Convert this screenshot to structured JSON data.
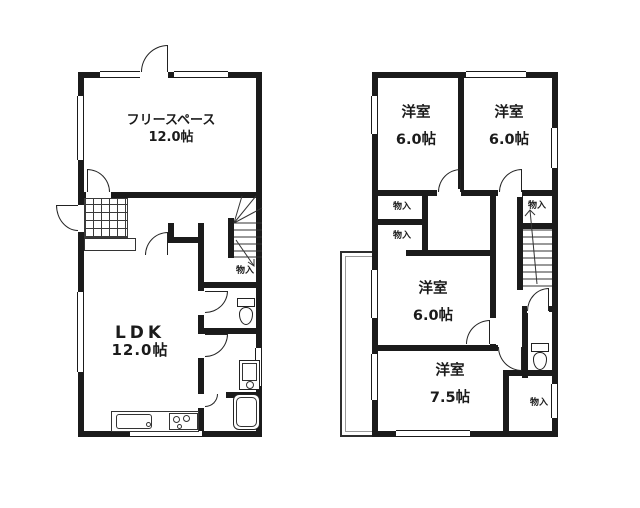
{
  "floor1": {
    "free_space_name": "フリースペース",
    "free_space_size": "12.0帖",
    "ldk_name": "LDK",
    "ldk_size": "12.0帖",
    "storage": "物入"
  },
  "floor2": {
    "room_tl_name": "洋室",
    "room_tl_size": "6.0帖",
    "room_tr_name": "洋室",
    "room_tr_size": "6.0帖",
    "room_mid_name": "洋室",
    "room_mid_size": "6.0帖",
    "room_btm_name": "洋室",
    "room_btm_size": "7.5帖",
    "storage1": "物入",
    "storage2": "物入",
    "storage3": "物入",
    "storage4": "物入"
  },
  "colors": {
    "wall": "#1b1b1b",
    "line": "#2b2b2b",
    "background": "#ffffff"
  }
}
